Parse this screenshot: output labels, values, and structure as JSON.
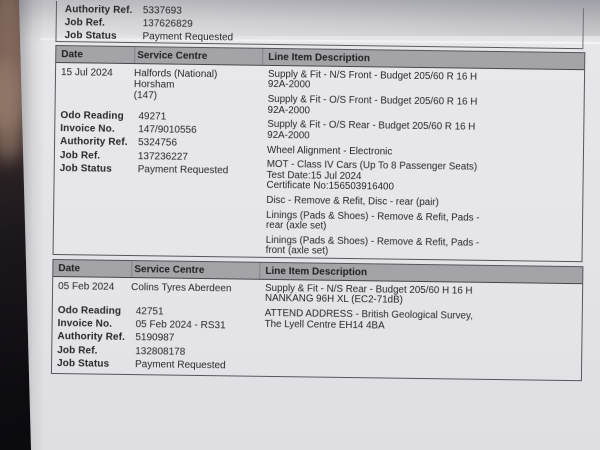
{
  "colors": {
    "paper": "#e4e4e8",
    "header_bar": "#a4a4a8",
    "table_border": "#55555c",
    "text": "#26262b",
    "background": "#0c0b10"
  },
  "partial_record": {
    "fields": [
      {
        "label": "Authority Ref.",
        "value": "5337693"
      },
      {
        "label": "Job Ref.",
        "value": "137626829"
      },
      {
        "label": "Job Status",
        "value": "Payment Requested"
      }
    ]
  },
  "table_headers": [
    "Date",
    "Service Centre",
    "Line Item Description"
  ],
  "records": [
    {
      "date": "15 Jul 2024",
      "service_centre": "Halfords (National) Horsham\n(147)",
      "fields": [
        {
          "label": "Odo Reading",
          "value": "49271"
        },
        {
          "label": "Invoice No.",
          "value": "147/9010556"
        },
        {
          "label": "Authority Ref.",
          "value": "5324756"
        },
        {
          "label": "Job Ref.",
          "value": "137236227"
        },
        {
          "label": "Job Status",
          "value": "Payment Requested"
        }
      ],
      "line_items": [
        "Supply & Fit - N/S Front - Budget 205/60 R 16 H\n92A-2000",
        "Supply & Fit - O/S Front - Budget 205/60 R 16 H\n92A-2000",
        "Supply & Fit - O/S Rear - Budget 205/60 R 16 H\n92A-2000",
        "Wheel Alignment - Electronic",
        "MOT - Class IV Cars (Up To 8 Passenger Seats)\nTest Date:15 Jul 2024\nCertificate No:156503916400",
        "Disc - Remove & Refit, Disc - rear (pair)",
        "Linings (Pads & Shoes) - Remove & Refit, Pads -\nrear (axle set)",
        "Linings (Pads & Shoes) - Remove & Refit, Pads -\nfront (axle set)"
      ]
    },
    {
      "date": "05 Feb 2024",
      "service_centre": "Colins Tyres Aberdeen",
      "fields": [
        {
          "label": "Odo Reading",
          "value": "42751"
        },
        {
          "label": "Invoice No.",
          "value": "05 Feb 2024 - RS31"
        },
        {
          "label": "Authority Ref.",
          "value": "5190987"
        },
        {
          "label": "Job Ref.",
          "value": "132808178"
        },
        {
          "label": "Job Status",
          "value": "Payment Requested"
        }
      ],
      "line_items": [
        "Supply & Fit - N/S Rear - Budget 205/60 H 16 H\nNANKANG 96H XL (EC2-71dB)",
        "ATTEND ADDRESS - British Geological Survey,\nThe Lyell Centre EH14 4BA"
      ]
    }
  ]
}
